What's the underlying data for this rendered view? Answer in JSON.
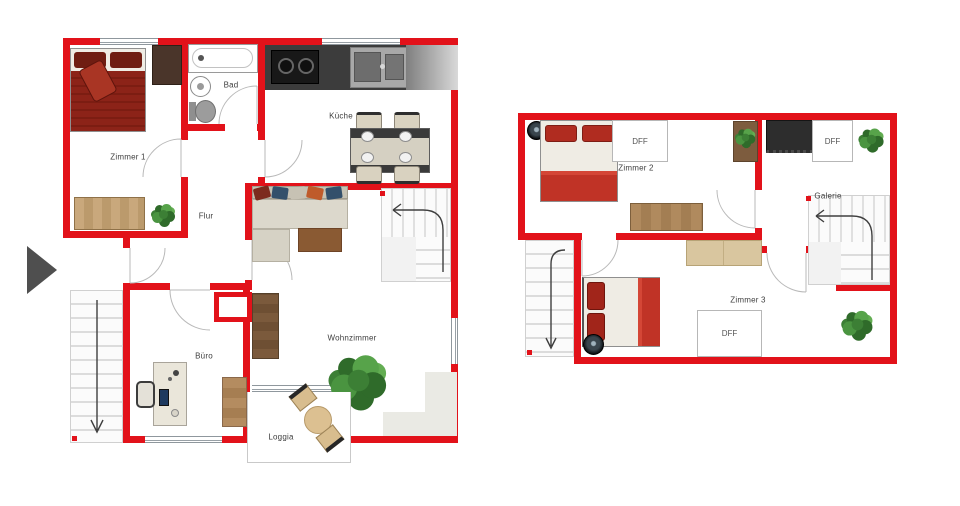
{
  "colors": {
    "wall": "#e2121a",
    "bed_dark_red": "#8c2318",
    "bed_red": "#c03326",
    "wood": "#b08a5e",
    "tan": "#d9c69f",
    "plant_green": "#3c7f35",
    "counter_dark": "#3c3c3c",
    "terrace_gray": "#eaeae4"
  },
  "floor1": {
    "labels": {
      "zimmer1": "Zimmer 1",
      "bad": "Bad",
      "kueche": "Küche",
      "flur": "Flur",
      "wohnzimmer": "Wohnzimmer",
      "buero": "Büro",
      "loggia": "Loggia"
    }
  },
  "floor2": {
    "labels": {
      "zimmer2": "Zimmer 2",
      "galerie": "Galerie",
      "zimmer3": "Zimmer 3",
      "dff1": "DFF",
      "dff2": "DFF",
      "dff3": "DFF"
    }
  }
}
